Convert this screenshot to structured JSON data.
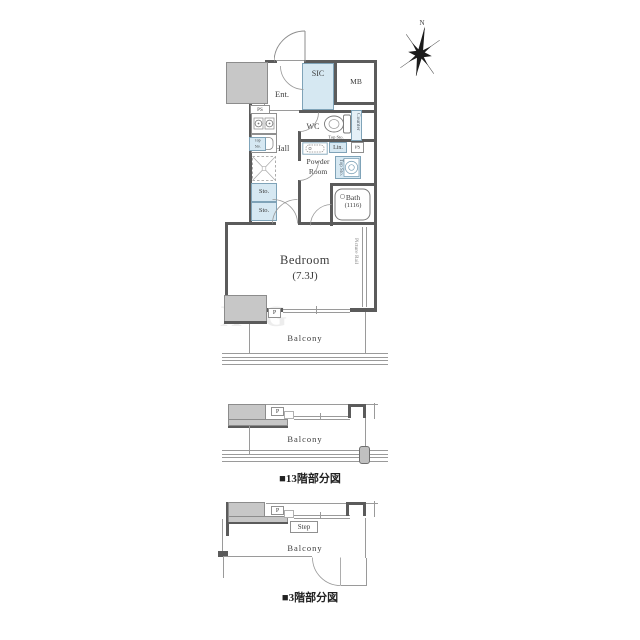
{
  "colors": {
    "wall": "#5b5b5b",
    "thin_line": "#9a9a9a",
    "gray_fill": "#c7c7c7",
    "accent_blue_fill": "#d6e8f2",
    "accent_blue_border": "#7fa3b8",
    "text": "#3c3c3c"
  },
  "compass": {
    "north": "N"
  },
  "main_plan": {
    "rooms": {
      "ent": "Ent.",
      "sic": "SIC",
      "mb": "MB",
      "wc": "WC",
      "hall": "Hall",
      "powder_line1": "Powder",
      "powder_line2": "Room",
      "bath": "Bath",
      "bath_size": "(1116)",
      "bedroom": "Bedroom",
      "bedroom_size": "(7.3J)",
      "balcony": "Balcony"
    },
    "labels": {
      "ps": "PS",
      "lin": "Lin.",
      "counter": "Counter",
      "top_sto": "Top Sto.",
      "top_sto_line1": "Top",
      "top_sto_line2": "Sto.",
      "sto": "Sto.",
      "picture_rail": "Picture Rail",
      "p": "P"
    }
  },
  "floor13_plan": {
    "balcony": "Balcony",
    "p": "P",
    "caption": "■13階部分図"
  },
  "floor3_plan": {
    "balcony": "Balcony",
    "p": "P",
    "step": "Step",
    "caption": "■3階部分図"
  },
  "watermark": "XG"
}
